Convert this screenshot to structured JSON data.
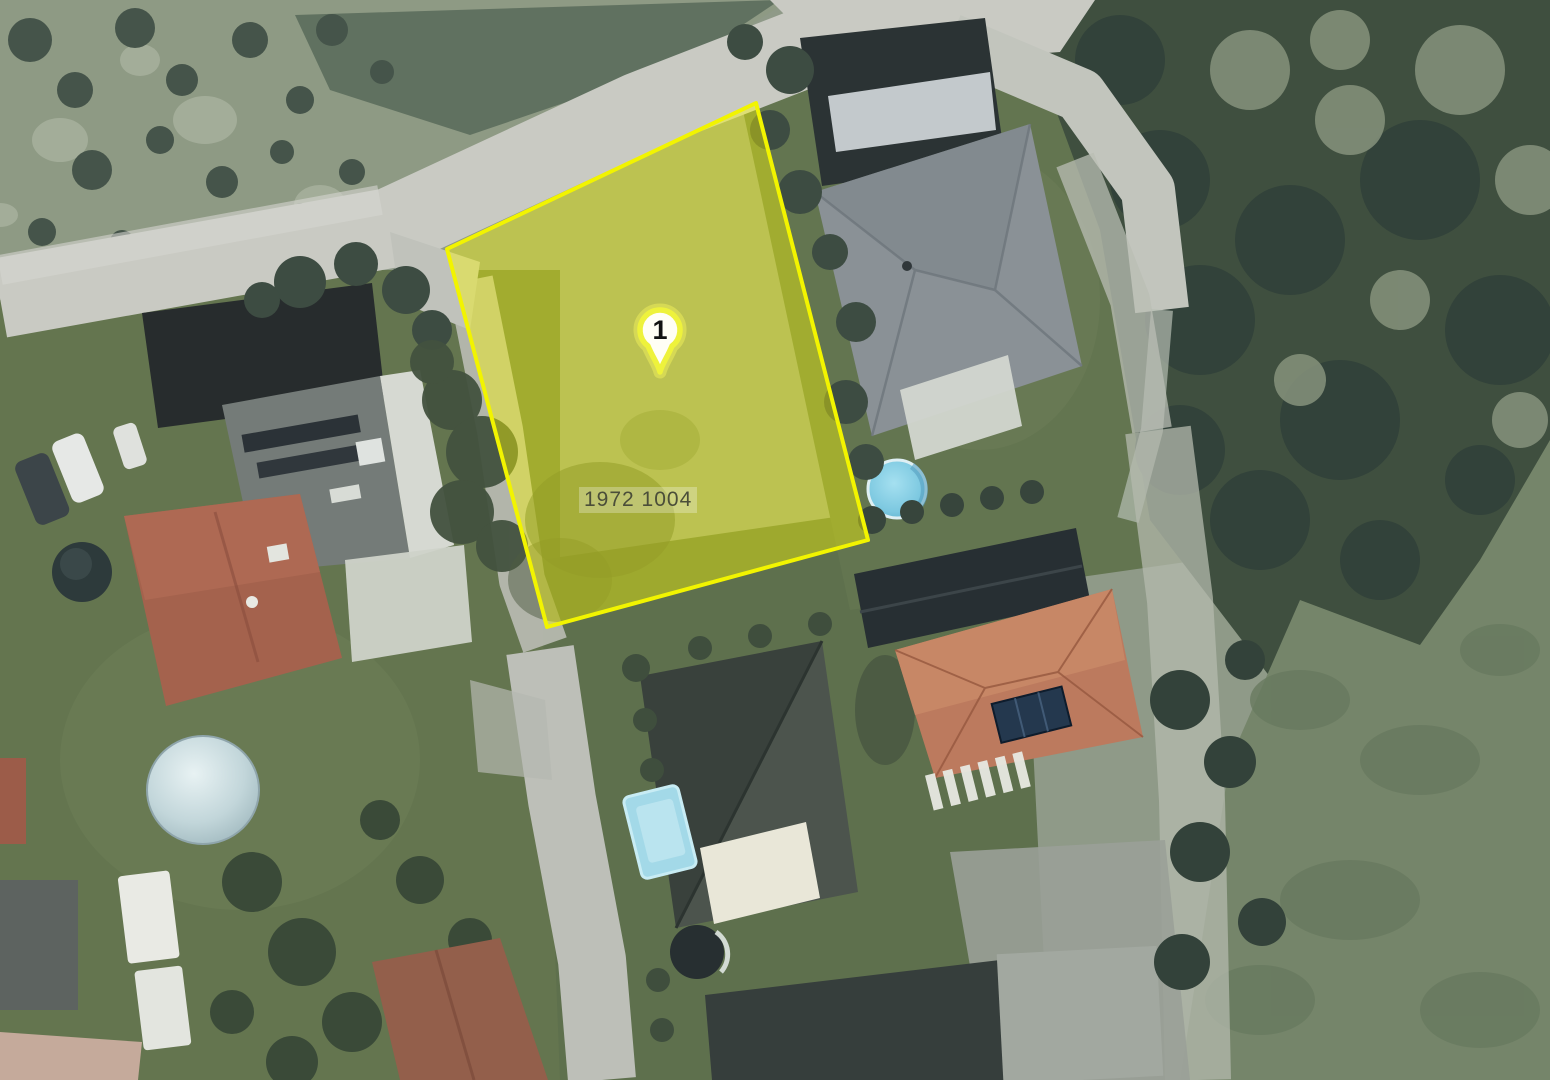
{
  "map": {
    "kind": "aerial-orthophoto-with-parcel-overlay"
  },
  "parcel": {
    "number": "19721004",
    "number_display": "1972 1004",
    "points": "756,103 447,249 547,627 868,540"
  },
  "marker": {
    "label": "1",
    "transform": "translate(660,372)"
  },
  "colors": {
    "parcel_fill": "#ffff00",
    "parcel_fill_opacity": "0.4",
    "parcel_stroke": "#f2f400",
    "marker_ring": "#eef23c",
    "marker_halo": "rgba(246,246,90,0.45)",
    "marker_fill": "#fffef5",
    "marker_text": "#121212",
    "label_text": "#4b4e39",
    "label_bg": "rgba(255,255,255,0.28)"
  }
}
